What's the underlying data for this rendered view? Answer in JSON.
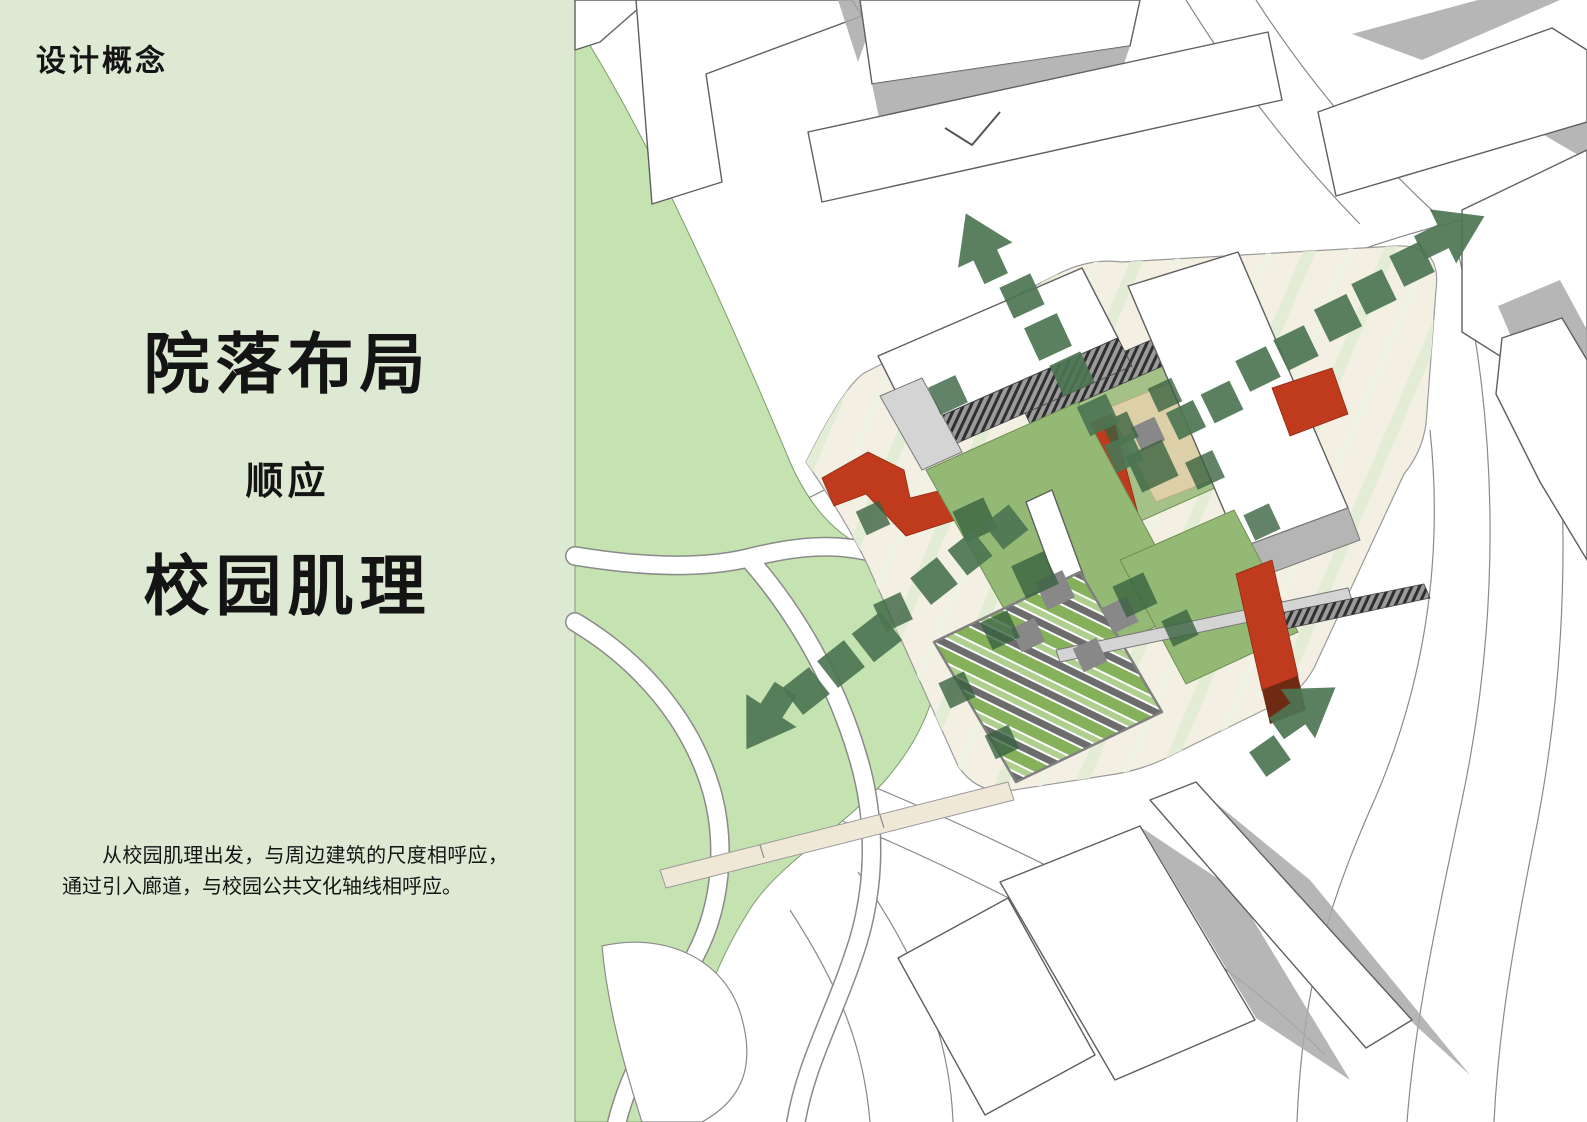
{
  "document": {
    "title": "设计概念"
  },
  "panel": {
    "bg_color": "#dee9d3",
    "text_color": "#141414",
    "header": "设计概念",
    "headline_primary": "院落布局",
    "headline_connector": "顺应",
    "headline_secondary": "校园肌理",
    "description": "从校园肌理出发，与周边建筑的尺度相呼应，通过引入廊道，与校园公共文化轴线相呼应。"
  },
  "site_plan": {
    "kind": "axonometric-campus-site-plan",
    "colors": {
      "park_green": "#c5e3b0",
      "plat_cream": "#f3f0e3",
      "stripe_green": "#e3edd6",
      "roof_green": "#94b975",
      "roof_green_light": "#a4c287",
      "tree_green": "#37603f",
      "axis_green": "#4c7553",
      "accent_red": "#c03a1e",
      "accent_dark_red": "#6e2a12",
      "accent_orange": "#f2a25a",
      "court_tan": "#ddd0a8",
      "shadow_gray": "#a9a9a9",
      "building_white": "#ffffff",
      "outline_gray": "#5f5f5f"
    },
    "axes": [
      {
        "name": "campus-axis-north",
        "style": "dotted-squares",
        "arrow_direction": "up"
      },
      {
        "name": "campus-axis-northeast",
        "style": "dotted-squares",
        "arrow_direction": "up-right"
      },
      {
        "name": "campus-axis-southwest",
        "style": "dotted-squares",
        "arrow_direction": "down-left"
      },
      {
        "name": "campus-axis-southeast",
        "style": "dotted-squares",
        "arrow_direction": "up-right"
      }
    ]
  }
}
